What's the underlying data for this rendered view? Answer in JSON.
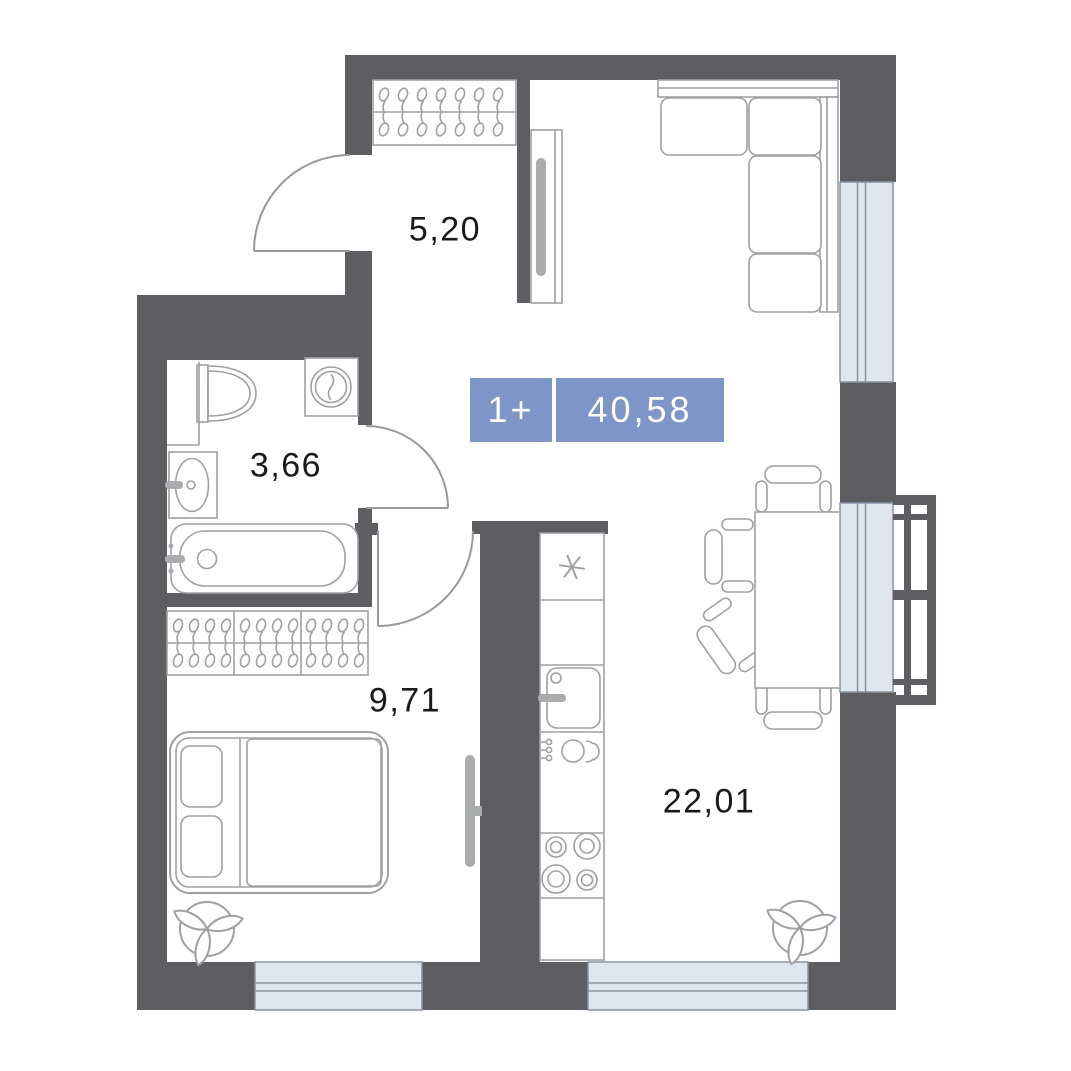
{
  "plan": {
    "type": "apartment-floorplan",
    "badge": {
      "rooms_label": "1+",
      "area_label": "40,58"
    },
    "rooms": [
      {
        "id": "hallway",
        "area": "5,20"
      },
      {
        "id": "bathroom",
        "area": "3,66"
      },
      {
        "id": "bedroom",
        "area": "9,71"
      },
      {
        "id": "living-kitchen",
        "area": "22,01"
      }
    ],
    "colors": {
      "wall": "#5e5e62",
      "line": "#a0a0a0",
      "door_line": "#9a9a9a",
      "gray_fill": "#a9abad",
      "window_fill": "#dee6f0",
      "window_line": "#8a94a2",
      "label_text": "#1a1a1a",
      "badge_bg": "#7e95c7",
      "badge_text": "#ffffff",
      "background": "#ffffff"
    },
    "furniture_icons": [
      "corner-sofa-icon",
      "tall-cabinet-icon",
      "hanger-rail-icon",
      "dining-table-icon",
      "chair-icon",
      "bed-icon",
      "tv-icon",
      "plant-icon",
      "kitchen-sink-icon",
      "dishwasher-icon",
      "stove-burners-icon",
      "freezer-asterisk-icon",
      "toilet-icon",
      "washing-machine-icon",
      "bathroom-sink-icon",
      "bathtub-icon",
      "door-swing-icon",
      "window-icon",
      "balcony-railing-icon"
    ]
  }
}
